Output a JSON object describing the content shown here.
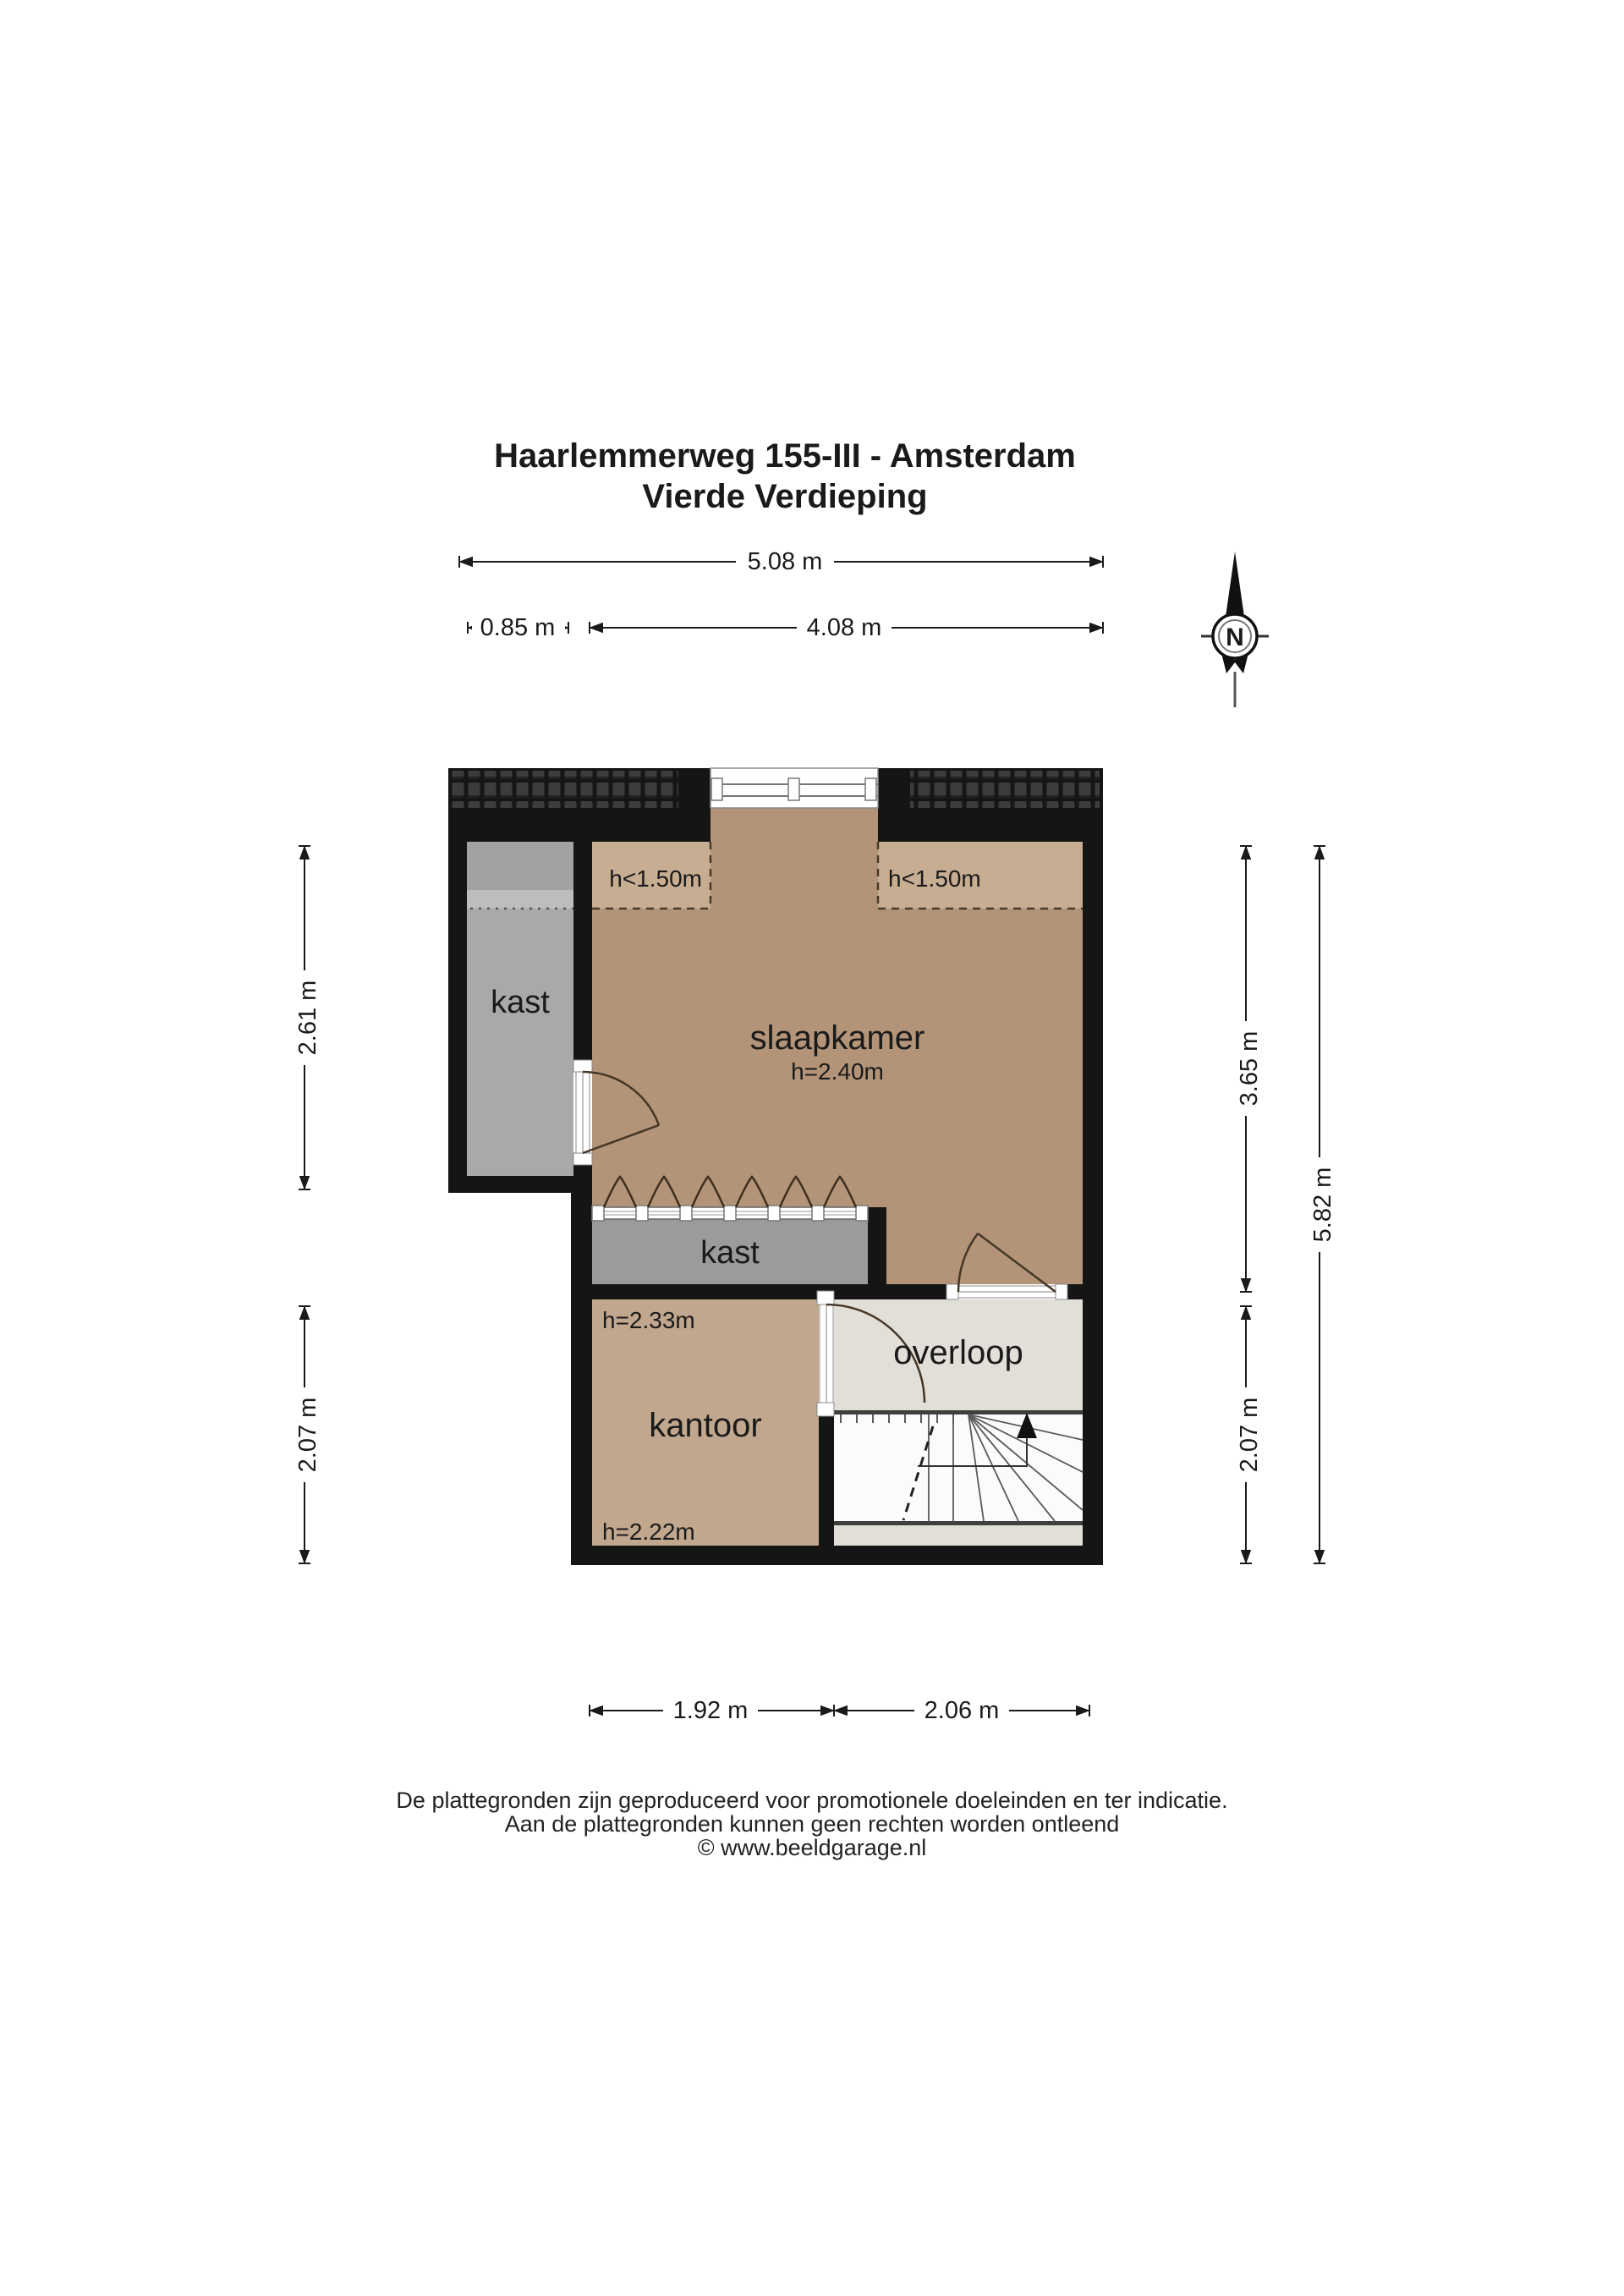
{
  "title": {
    "line1": "Haarlemmerweg 155-III - Amsterdam",
    "line2": "Vierde Verdieping"
  },
  "compass": {
    "north_label": "N"
  },
  "rooms": {
    "closet_left": {
      "label": "kast"
    },
    "bedroom": {
      "label": "slaapkamer",
      "height": "h=2.40m"
    },
    "low_headroom_left": {
      "label": "h<1.50m"
    },
    "low_headroom_right": {
      "label": "h<1.50m"
    },
    "wardrobe": {
      "label": "kast"
    },
    "office": {
      "label": "kantoor",
      "height_top": "h=2.33m",
      "height_bottom": "h=2.22m"
    },
    "landing": {
      "label": "overloop"
    }
  },
  "dimensions": {
    "top_total": "5.08 m",
    "top_left": "0.85 m",
    "top_right": "4.08 m",
    "left_upper": "2.61 m",
    "left_lower": "2.07 m",
    "right_upper": "3.65 m",
    "right_lower": "2.07 m",
    "right_total": "5.82 m",
    "bottom_left": "1.92 m",
    "bottom_right": "2.06 m"
  },
  "footer": {
    "line1": "De plattegronden zijn geproduceerd voor promotionele doeleinden en ter indicatie.",
    "line2": "Aan de plattegronden kunnen geen rechten worden ontleend",
    "line3": "© www.beeldgarage.nl"
  },
  "colors": {
    "wall": "#151515",
    "bedroom_floor": "#b39478",
    "low_headroom_floor": "#c7ad92",
    "office_floor": "#c1a78d",
    "closet_floor": "#a9a9a9",
    "closet_floor_top": "#a2a2a2",
    "closet_floor_mid": "#bdbdbd",
    "wardrobe_floor": "#9b9b9b",
    "landing_floor": "#e2dfd8",
    "stairs_floor": "#fbfbfa"
  }
}
